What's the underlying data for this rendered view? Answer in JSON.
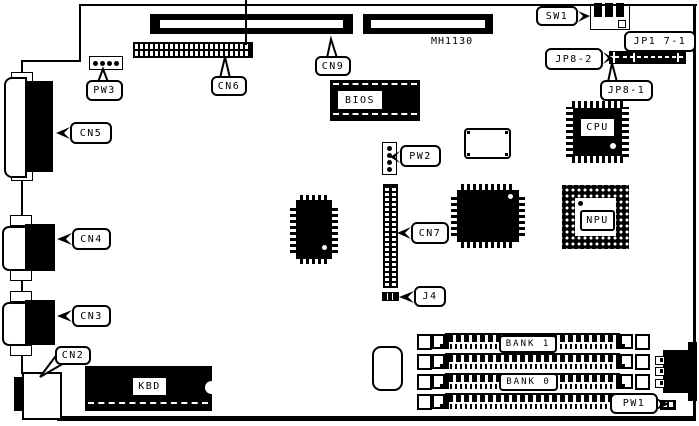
{
  "diagram": {
    "silkscreen_text": "MH1130",
    "callouts": {
      "sw1": "SW1",
      "jp1_7_1": "JP1 7-1",
      "jp8_2": "JP8-2",
      "jp8_1": "JP8-1",
      "cn9": "CN9",
      "cn6": "CN6",
      "pw3": "PW3",
      "cn5": "CN5",
      "pw2": "PW2",
      "cn4": "CN4",
      "cn7": "CN7",
      "cn3": "CN3",
      "j4": "J4",
      "cn2": "CN2",
      "pw1": "PW1"
    },
    "chip_labels": {
      "bios": "BIOS",
      "cpu": "CPU",
      "npu": "NPU",
      "kbd": "KBD"
    },
    "bank_labels": {
      "bank1": "BANK 1",
      "bank0": "BANK 0"
    },
    "colors": {
      "ink": "#000000",
      "paper": "#ffffff"
    }
  }
}
